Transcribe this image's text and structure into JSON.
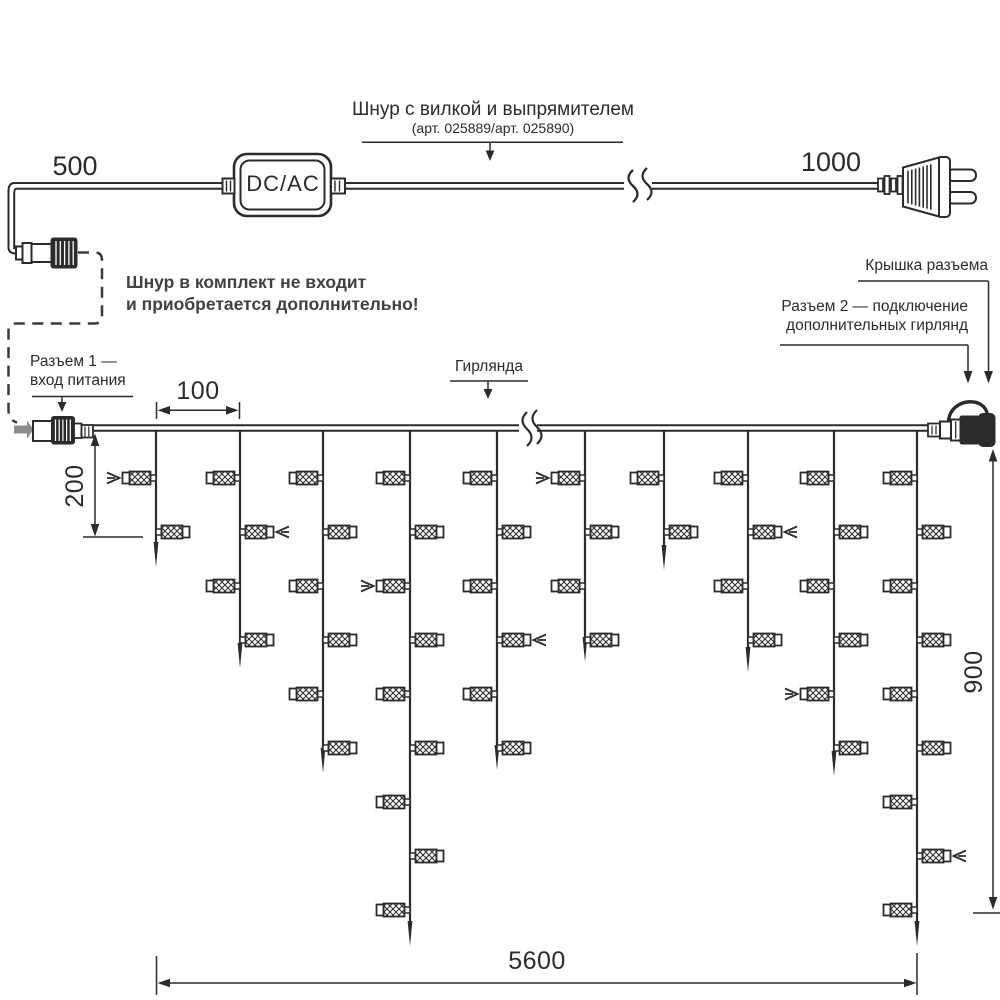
{
  "title": {
    "text": "Шнур с вилкой и выпрямителем",
    "subtitle": "(арт. 025889/арт. 025890)"
  },
  "labels": {
    "cord_length_left": "500",
    "cord_length_right": "1000",
    "dcac": "DC/AC",
    "note_line1": "Шнур в комплект не входит",
    "note_line2": "и приобретается дополнительно!",
    "connector1_line1": "Разъем 1 —",
    "connector1_line2": "вход питания",
    "garland": "Гирлянда",
    "cap": "Крышка разъема",
    "connector2_line1": "Разъем 2 — подключение",
    "connector2_line2": "дополнительных гирлянд"
  },
  "dimensions": {
    "drop_spacing": "100",
    "first_drop_length": "200",
    "max_drop_length": "900",
    "total_length": "5600"
  },
  "colors": {
    "line": "#2b2b2b",
    "note_text": "#414141",
    "gray_arrow": "#8c8c8c",
    "dashed": "#3a3a3a",
    "background": "#ffffff"
  },
  "garland": {
    "wire_y": 428,
    "wire_x_start": 93,
    "wire_x_end": 930,
    "break_x": 528,
    "lamp_row_start_y": 478,
    "lamp_row_spacing": 54,
    "drops": [
      {
        "x": 156,
        "lamps": 2,
        "tip_y": 567
      },
      {
        "x": 240,
        "lamps": 4,
        "tip_y": 668
      },
      {
        "x": 323,
        "lamps": 6,
        "tip_y": 773
      },
      {
        "x": 410,
        "lamps": 9,
        "tip_y": 946
      },
      {
        "x": 497,
        "lamps": 6,
        "tip_y": 770
      },
      {
        "x": 585,
        "lamps": 4,
        "tip_y": 662
      },
      {
        "x": 664,
        "lamps": 2,
        "tip_y": 570
      },
      {
        "x": 748,
        "lamps": 4,
        "tip_y": 672
      },
      {
        "x": 834,
        "lamps": 6,
        "tip_y": 776
      },
      {
        "x": 917,
        "lamps": 9,
        "tip_y": 946
      }
    ],
    "flash_arrows": [
      {
        "drop": 0,
        "row": 1
      },
      {
        "drop": 1,
        "row": 2
      },
      {
        "drop": 3,
        "row": 3
      },
      {
        "drop": 4,
        "row": 4
      },
      {
        "drop": 5,
        "row": 1
      },
      {
        "drop": 7,
        "row": 2
      },
      {
        "drop": 8,
        "row": 5
      },
      {
        "drop": 9,
        "row": 8
      }
    ]
  }
}
